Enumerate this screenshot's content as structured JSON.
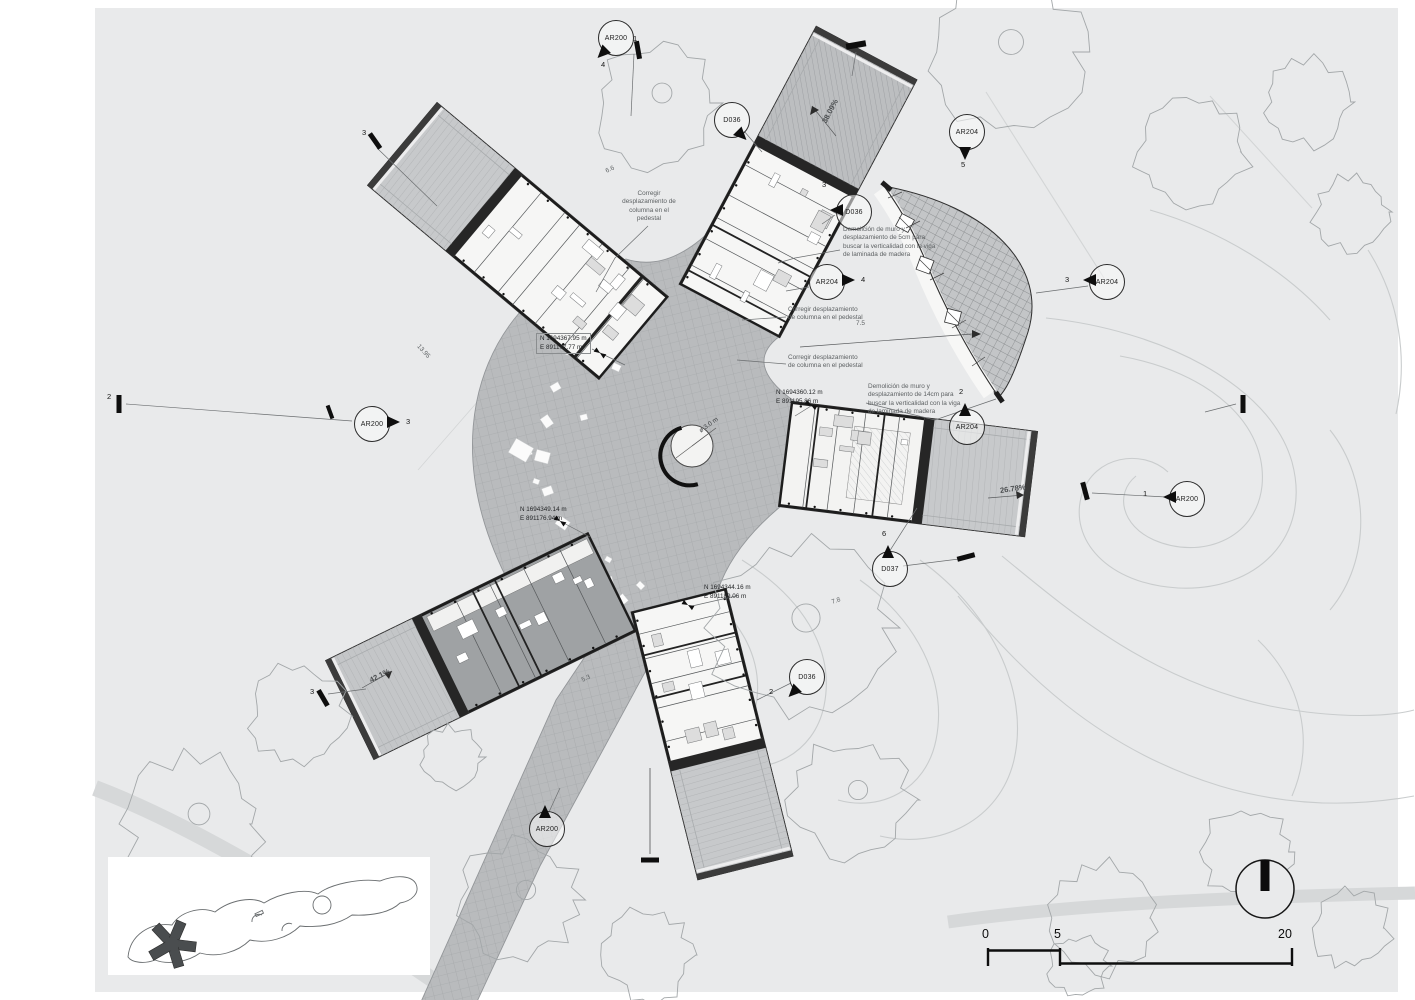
{
  "drawing": {
    "type": "architectural-site-plan",
    "colors": {
      "paper": "#e9eaeb",
      "plaza": "#b9bbbd",
      "roof_light": "#c7c9cb",
      "roof_dark": "#bcbec0",
      "wall_dark": "#262626",
      "tree_outline": "#a3a7a9",
      "contour": "#c9cccd",
      "road": "#d6d8d9",
      "annotation_text": "#5d6163"
    },
    "icons": {
      "north_arrow": "north-direction-indicator",
      "key_plan": "site-location-inset"
    }
  },
  "markers": [
    {
      "label": "AR200",
      "x": 615,
      "y": 37,
      "tri": "sw",
      "labels": [
        {
          "t": "4",
          "dx": 3,
          "dy": 40
        }
      ]
    },
    {
      "label": "D036",
      "x": 731,
      "y": 119,
      "tri": "se",
      "labels": []
    },
    {
      "label": "D036",
      "x": 853,
      "y": 211,
      "tri": "w",
      "labels": [
        {
          "t": "3",
          "dx": -14,
          "dy": -14
        }
      ]
    },
    {
      "label": "AR204",
      "x": 966,
      "y": 131,
      "tri": "s",
      "labels": [
        {
          "t": "5",
          "dx": 12,
          "dy": 46
        }
      ]
    },
    {
      "label": "AR204",
      "x": 826,
      "y": 281,
      "tri": "e",
      "labels": [
        {
          "t": "4",
          "dx": 52,
          "dy": 11
        }
      ]
    },
    {
      "label": "AR204",
      "x": 1106,
      "y": 281,
      "tri": "w",
      "labels": [
        {
          "t": "3",
          "dx": -24,
          "dy": 11
        }
      ]
    },
    {
      "label": "AR204",
      "x": 966,
      "y": 426,
      "tri": "n",
      "labels": [
        {
          "t": "2",
          "dx": 10,
          "dy": -22
        }
      ]
    },
    {
      "label": "D037",
      "x": 889,
      "y": 568,
      "tri": "n",
      "labels": [
        {
          "t": "6",
          "dx": 10,
          "dy": -22
        }
      ]
    },
    {
      "label": "D036",
      "x": 806,
      "y": 676,
      "tri": "sw",
      "labels": [
        {
          "t": "2",
          "dx": -20,
          "dy": 28
        }
      ]
    },
    {
      "label": "AR200",
      "x": 371,
      "y": 423,
      "tri": "e",
      "labels": [
        {
          "t": "3",
          "dx": 52,
          "dy": 11
        }
      ]
    },
    {
      "label": "AR200",
      "x": 1186,
      "y": 498,
      "tri": "w",
      "labels": [
        {
          "t": "1",
          "dx": -26,
          "dy": 8
        }
      ]
    },
    {
      "label": "AR200",
      "x": 546,
      "y": 828,
      "tri": "n",
      "labels": []
    }
  ],
  "annotations": [
    {
      "x": 613,
      "y": 190,
      "w": 72,
      "align": "center",
      "text": "Corregir\ndesplazamiento de\ncolumna en el\npedestal"
    },
    {
      "x": 843,
      "y": 226,
      "w": 118,
      "align": "left",
      "text": "Demolición de muro y\ndesplazamiento de 5cm para\nbuscar la verticalidad con la viga\nde laminada de madera"
    },
    {
      "x": 788,
      "y": 306,
      "w": 120,
      "align": "left",
      "text": "Corregir desplazamiento\nde columna en el pedestal"
    },
    {
      "x": 788,
      "y": 354,
      "w": 120,
      "align": "left",
      "text": "Corregir desplazamiento\nde columna en el pedestal"
    },
    {
      "x": 868,
      "y": 383,
      "w": 118,
      "align": "left",
      "text": "Demolición de muro y\ndesplazamiento de 14cm para\nbuscar la verticalidad con la viga\nde laminada de madera"
    }
  ],
  "coordinates": [
    {
      "x": 536,
      "y": 333,
      "boxed": true,
      "text": "N 1694367.95 m\nE 891177.77 m"
    },
    {
      "x": 520,
      "y": 506,
      "boxed": false,
      "text": "N 1694349.14 m\nE 891176.94 m"
    },
    {
      "x": 776,
      "y": 389,
      "boxed": false,
      "text": "N 1694360.12 m\nE 891195.86 m"
    },
    {
      "x": 704,
      "y": 584,
      "boxed": false,
      "text": "N 1694344.16 m\nE 891189.06 m"
    }
  ],
  "slopes": [
    {
      "x": 824,
      "y": 118,
      "rot": -62,
      "text": "38.09%"
    },
    {
      "x": 370,
      "y": 676,
      "rot": -27,
      "text": "42.1%"
    },
    {
      "x": 1000,
      "y": 486,
      "rot": -8,
      "text": "26.78%"
    }
  ],
  "dims": [
    {
      "x": 856,
      "y": 320,
      "rot": 0,
      "text": "7.5"
    },
    {
      "x": 606,
      "y": 168,
      "rot": -25,
      "text": "6.6"
    },
    {
      "x": 418,
      "y": 342,
      "rot": 48,
      "text": "13.95"
    },
    {
      "x": 582,
      "y": 677,
      "rot": -25,
      "text": "5.3"
    },
    {
      "x": 832,
      "y": 599,
      "rot": -20,
      "text": "7.8"
    }
  ],
  "section_labels": [
    {
      "t": "1",
      "x": 633,
      "y": 34
    },
    {
      "t": "3",
      "x": 362,
      "y": 128
    },
    {
      "t": "2",
      "x": 107,
      "y": 392
    },
    {
      "t": "3",
      "x": 310,
      "y": 687
    }
  ],
  "center_label": {
    "text": "ø 3.0 m"
  },
  "scale_bar": {
    "labels": [
      {
        "t": "0",
        "x": 982,
        "y": 927
      },
      {
        "t": "5",
        "x": 1054,
        "y": 927
      },
      {
        "t": "20",
        "x": 1278,
        "y": 927
      }
    ]
  }
}
